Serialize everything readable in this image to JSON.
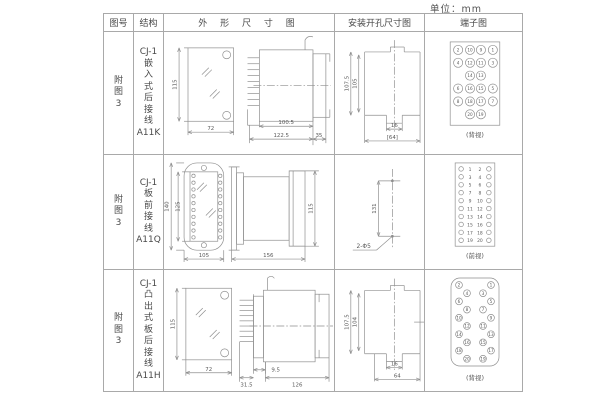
{
  "unit_label": "单位：mm",
  "table": {
    "headers": {
      "fig_no": "图号",
      "structure": "结构",
      "outline": "外 形 尺 寸 图",
      "install": "安装开孔尺寸图",
      "terminal": "端子图"
    },
    "rows": [
      {
        "fig_no": "附\n图\n3",
        "structure": "CJ-1\n嵌\n入\n式\n后\n接\n线\nA11K"
      },
      {
        "fig_no": "附\n图\n3",
        "structure": "CJ-1\n板\n前\n接\n线\nA11Q"
      },
      {
        "fig_no": "附\n图\n3",
        "structure": "CJ-1\n凸\n出\n式\n板\n后\n接\n线\nA11H"
      }
    ]
  },
  "drawings": {
    "r1_outline": {
      "front_height": "115",
      "front_width": "72",
      "side_body": "100.5",
      "side_total": "122.5",
      "side_flange": "35"
    },
    "r1_install": {
      "outer": "107.5",
      "inner": "105",
      "notch": "16",
      "width": "[64]"
    },
    "r1_terminal": {
      "caption": "(背视)",
      "grid": [
        [
          "2",
          "10",
          "9",
          "1"
        ],
        [
          "4",
          "12",
          "11",
          "3"
        ],
        [
          "",
          "14",
          "13",
          ""
        ],
        [
          "6",
          "16",
          "15",
          "5"
        ],
        [
          "8",
          "18",
          "17",
          "7"
        ],
        [
          "",
          "20",
          "19",
          ""
        ]
      ]
    },
    "r2_outline": {
      "outer_height": "140",
      "inner_height": "125",
      "width": "105",
      "side_length": "156",
      "side_height": "115"
    },
    "r2_install": {
      "spacing": "131",
      "holes": "2-Φ5"
    },
    "r2_terminal": {
      "caption": "(前视)",
      "pairs": [
        [
          "1",
          "2"
        ],
        [
          "3",
          "4"
        ],
        [
          "5",
          "6"
        ],
        [
          "7",
          "8"
        ],
        [
          "9",
          "10"
        ],
        [
          "11",
          "12"
        ],
        [
          "13",
          "14"
        ],
        [
          "15",
          "16"
        ],
        [
          "17",
          "18"
        ],
        [
          "19",
          "20"
        ]
      ]
    },
    "r3_outline": {
      "front_height": "115",
      "front_width": "72",
      "pin_offset": "9.5",
      "pin_length": "31.5",
      "body_length": "126"
    },
    "r3_install": {
      "outer": "107.5",
      "inner": "104",
      "notch": "16",
      "width": "64"
    },
    "r3_terminal": {
      "caption": "(背视)",
      "left": [
        "2",
        "4",
        "6",
        "8",
        "10",
        "12",
        "14",
        "16",
        "18",
        "20"
      ],
      "right": [
        "1",
        "3",
        "5",
        "7",
        "9",
        "11",
        "13",
        "15",
        "17",
        "19"
      ]
    }
  }
}
